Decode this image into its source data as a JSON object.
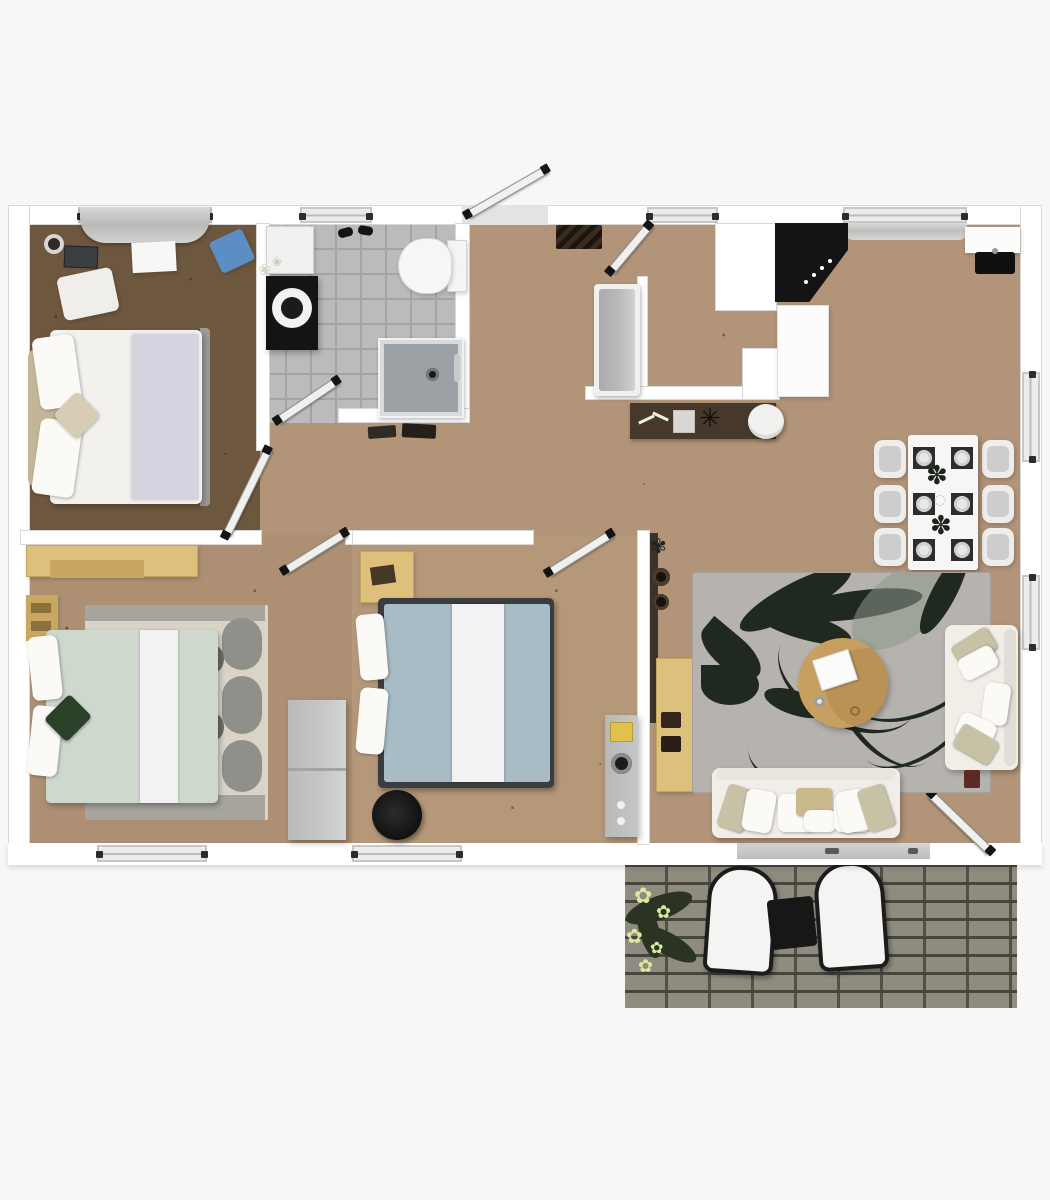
{
  "scene": {
    "type": "3d-top-view-floor-plan",
    "description_visible_text": "",
    "rooms": [
      {
        "id": "bedroom-1",
        "position": "top-left",
        "furniture": [
          "double-bed-white-lavender",
          "beige-headboard",
          "window-curtain",
          "speaker",
          "tablet",
          "paper-sheet",
          "blue-cushion",
          "white-rug"
        ]
      },
      {
        "id": "bathroom",
        "position": "top-center-left",
        "furniture": [
          "toilet",
          "black-vanity-with-round-sink",
          "white-cabinet",
          "shower-tray",
          "slippers",
          "bath-mats",
          "flower-vase"
        ]
      },
      {
        "id": "hallway-entry",
        "position": "center",
        "furniture": [
          "front-door",
          "interior-door",
          "chevron-doormat",
          "grey-bench",
          "dark-console-mat",
          "keys",
          "glass-box",
          "star-ornament",
          "round-white-rug"
        ]
      },
      {
        "id": "kitchen",
        "position": "top-right",
        "furniture": [
          "black-corner-cooktop",
          "white-cabinet-column",
          "white-counter",
          "black-sink",
          "window-blind"
        ]
      },
      {
        "id": "dining-area",
        "position": "right",
        "furniture": [
          "white-dining-table",
          "six-chairs",
          "six-place-settings",
          "two-dark-centerpieces"
        ]
      },
      {
        "id": "living-room",
        "position": "bottom-right",
        "furniture": [
          "grey-floral-rug",
          "round-wooden-coffee-table",
          "laptop",
          "sofa-right",
          "sofa-bottom",
          "tan-sideboard",
          "dark-wall-shelf",
          "red-box",
          "sliding-glass-door"
        ]
      },
      {
        "id": "bedroom-2",
        "position": "bottom-left",
        "furniture": [
          "double-bed-sage",
          "patterned-rug",
          "tan-wardrobe",
          "tan-nightstand",
          "green-cushion",
          "grey-cabinet"
        ]
      },
      {
        "id": "bedroom-3",
        "position": "bottom-center",
        "furniture": [
          "double-bed-blue",
          "tan-desk",
          "dark-pouf",
          "grey-dresser-with-yellow-item"
        ]
      },
      {
        "id": "patio",
        "position": "bottom-right-outside",
        "furniture": [
          "brick-paving",
          "two-white-lounge-chairs",
          "black-side-table",
          "yellow-flower-plant"
        ]
      }
    ],
    "openings": {
      "windows_top": 4,
      "windows_bottom": 2,
      "windows_right": 2,
      "doors": [
        "front-door-open-out",
        "hall-door",
        "bedroom-1-door",
        "bathroom-door",
        "bedroom-2-door",
        "bedroom-3-door",
        "terrace-door-open-in"
      ]
    }
  },
  "palette": {
    "bg": "#f7f7f6",
    "wall": "#ffffff",
    "wall_edge": "#d8d8d6",
    "window_glass": "#ececea",
    "window_frame": "#c7c7c5",
    "door_leaf": "#f0f0ee",
    "wood_hall": "#b29478",
    "wood_bed1": "#6e573f",
    "wood_bed2": "#ad8f74",
    "wood_bed3": "#b59879",
    "tile": "#babbbc",
    "tile_line": "#a4a4a6",
    "shower": "#9ba1a4",
    "black": "#141414",
    "counter": "#fcfcfa",
    "bench": "#b8babb",
    "mat_brown": "#46382a",
    "rug": "#b6b3ae",
    "rug_leaf": "#20291f",
    "rug_leaf_light": "#8c978c",
    "sofa": "#f0eee7",
    "pillow_beige": "#c7c2a6",
    "coffee": "#c79f61",
    "coffee_dark": "#b28b4f",
    "duvet_white": "#f3f1ee",
    "lavender": "#d7d2e0",
    "headboard": "#c3b697",
    "sage": "#ced8cc",
    "rug2": "#dad4c7",
    "rug2_pat": "#90908a",
    "blue": "#a8bcc5",
    "runner": "#f1f2f1",
    "frame_dark": "#3a3d3f",
    "tan": "#dcc07c",
    "tan_dark": "#c8a760",
    "dresser": "#c6c8c8",
    "chair": "#ededeb",
    "chair_seat": "#cdcdcb",
    "table_white": "#f6f6f4",
    "brick": "#8f8c7f",
    "brick_line": "#47453e",
    "lounge": "#f4f4f2",
    "flower": "#dce79f",
    "leaf_dark": "#2b3423",
    "green_cushion": "#2a4029",
    "blue_item": "#5b8fc3",
    "red_box": "#5c2a22",
    "glass_door": "#c9cbcb"
  }
}
